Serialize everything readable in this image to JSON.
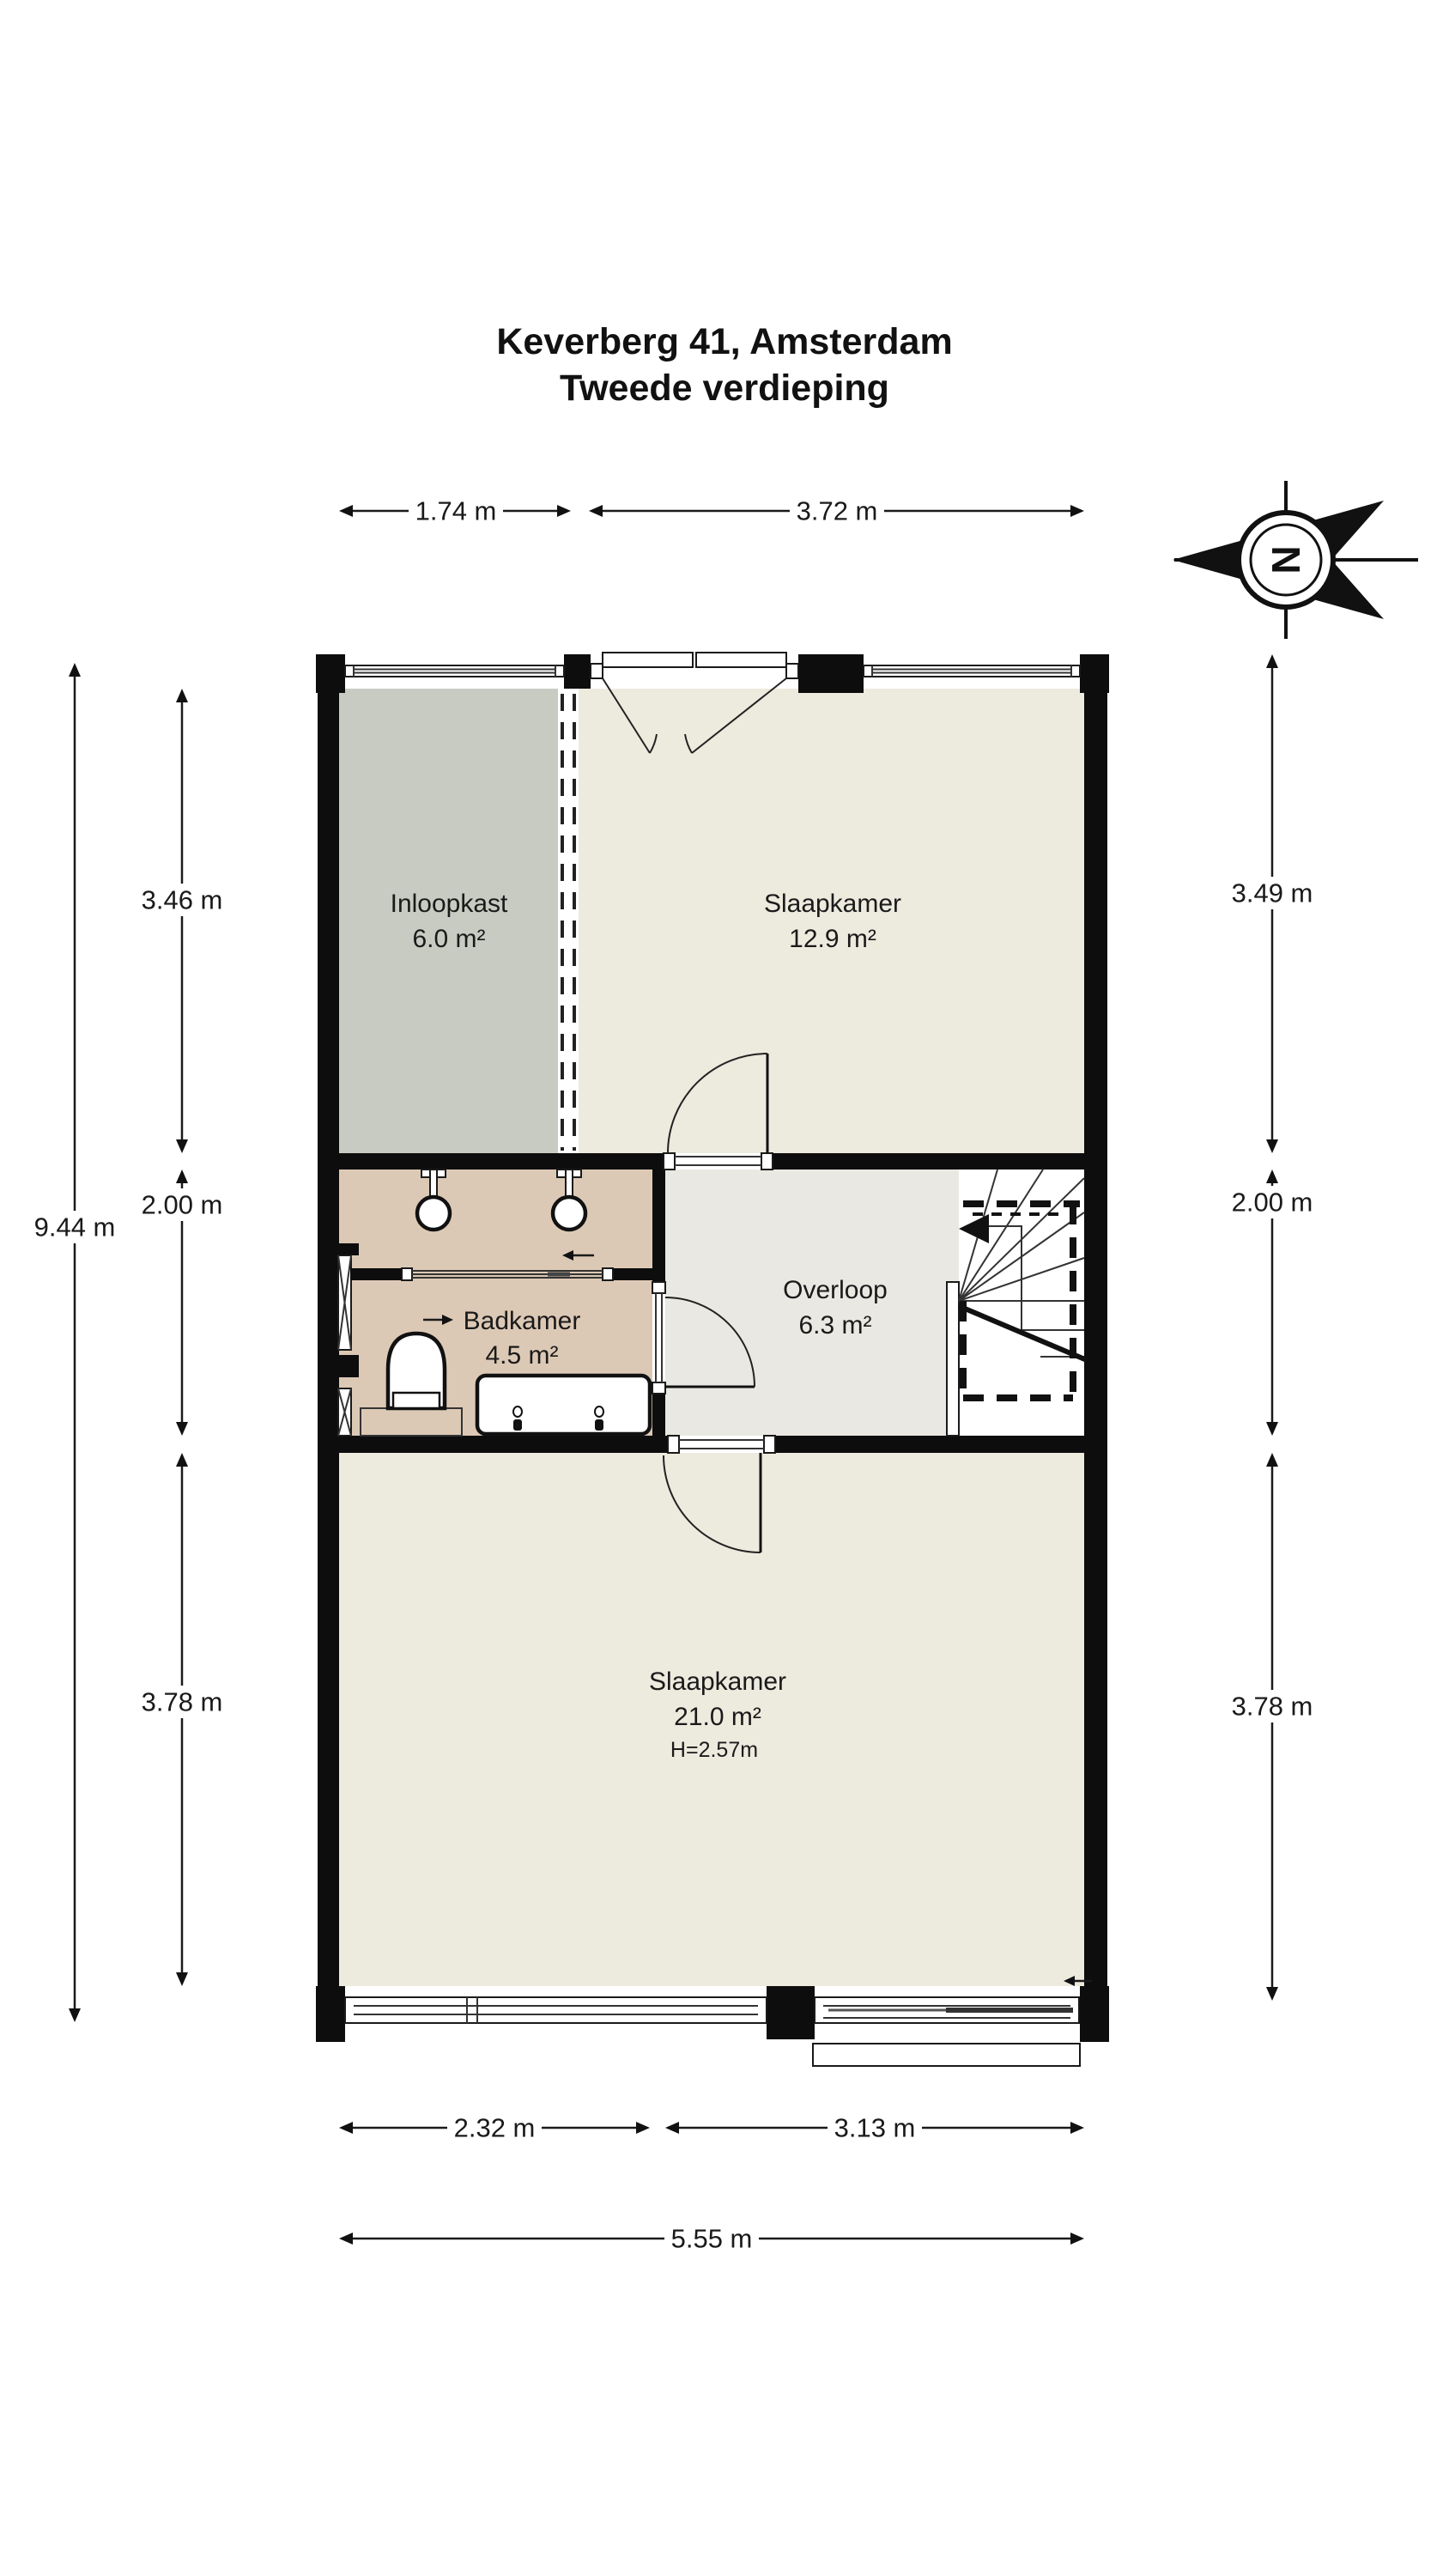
{
  "title": {
    "line1": "Keverberg 41, Amsterdam",
    "line2": "Tweede verdieping"
  },
  "compass": {
    "letter": "N"
  },
  "rooms": [
    {
      "id": "inloopkast",
      "name": "Inloopkast",
      "area": "6.0 m²"
    },
    {
      "id": "slaapkamer1",
      "name": "Slaapkamer",
      "area": "12.9 m²"
    },
    {
      "id": "badkamer",
      "name": "Badkamer",
      "area": "4.5 m²"
    },
    {
      "id": "overloop",
      "name": "Overloop",
      "area": "6.3 m²"
    },
    {
      "id": "slaapkamer2",
      "name": "Slaapkamer",
      "area": "21.0 m²",
      "height": "H=2.57m"
    }
  ],
  "dimensions": {
    "top": [
      {
        "label": "1.74 m"
      },
      {
        "label": "3.72 m"
      }
    ],
    "bottom": [
      {
        "label": "2.32 m"
      },
      {
        "label": "3.13 m"
      }
    ],
    "bottom_total": "5.55 m",
    "left": [
      {
        "label": "3.46 m"
      },
      {
        "label": "2.00 m"
      },
      {
        "label": "3.78 m"
      }
    ],
    "left_total": "9.44 m",
    "right": [
      {
        "label": "3.49 m"
      },
      {
        "label": "2.00 m"
      },
      {
        "label": "3.78 m"
      }
    ]
  },
  "colors": {
    "wall": "#0d0d0d",
    "bedroom": "#edeade",
    "closet": "#c8cbc2",
    "bath": "#dcc9b5",
    "hall": "#e9e8e2",
    "stair": "#ffffff"
  }
}
